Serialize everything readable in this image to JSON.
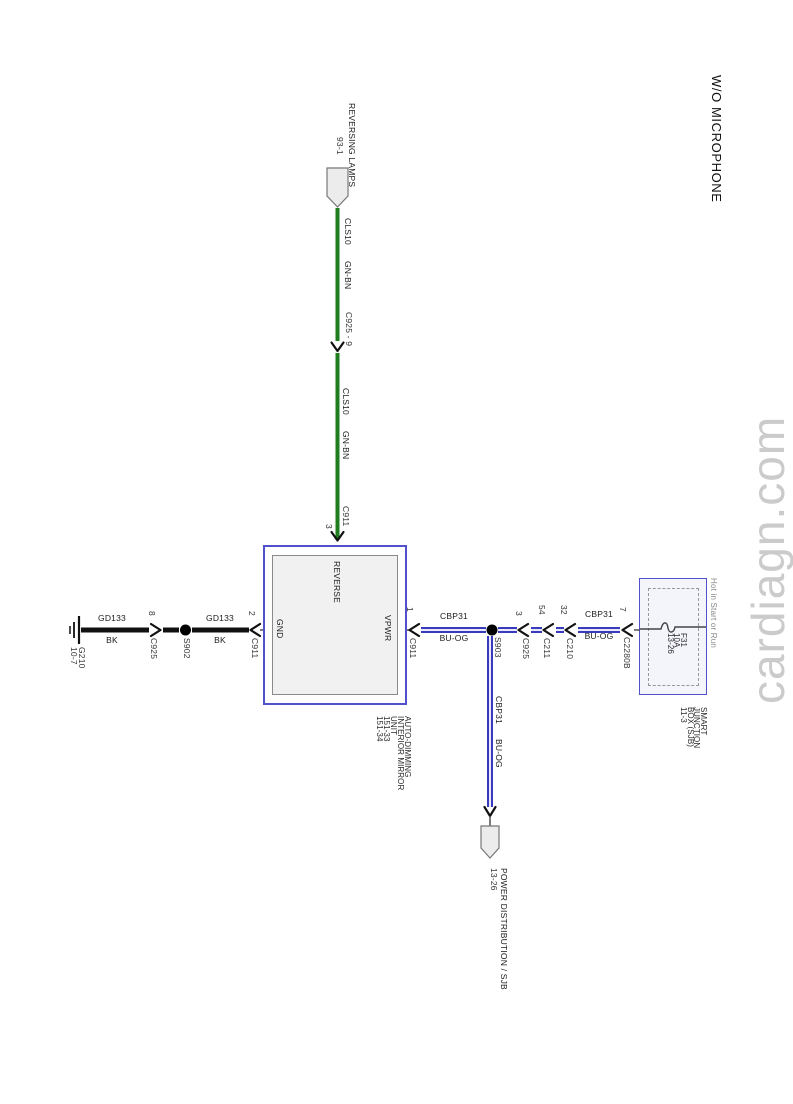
{
  "title": "W/O MICROPHONE",
  "watermark": "cardiagn.com",
  "colors": {
    "green_wire": "#1e7d1e",
    "blue_wire": "#3a3abc",
    "box_border": "#5151cd",
    "watermark_gray": "#cbcbcb",
    "muted_text": "#8a8a8a"
  },
  "offpage_top": {
    "name": "REVERSING LAMPS",
    "page_ref": "93-1"
  },
  "reverse_wire": {
    "seg1": {
      "circuit": "CLS10",
      "color": "GN-BN"
    },
    "connector1": {
      "name": "C925 - 9"
    },
    "seg2": {
      "circuit": "CLS10",
      "color": "GN-BN"
    },
    "connector2": {
      "name": "C911",
      "pin": "3"
    }
  },
  "mirror_unit": {
    "pins": {
      "reverse": "REVERSE",
      "gnd": "GND",
      "vpwr": "VPWR"
    },
    "label_lines": [
      "AUTO-DIMMING",
      "INTERIOR MIRROR",
      "UNIT",
      "151-33",
      "151-34"
    ]
  },
  "gnd_branch": {
    "c911": {
      "name": "C911",
      "pin": "2"
    },
    "wire1": {
      "circuit": "GD133",
      "color": "BK"
    },
    "splice": "S902",
    "c925": {
      "name": "C925",
      "pin": "8"
    },
    "wire2": {
      "circuit": "GD133",
      "color": "BK"
    },
    "ground": {
      "name": "G210",
      "page_ref": "10-7"
    }
  },
  "vpwr_branch": {
    "c911": {
      "name": "C911",
      "pin": "1"
    },
    "wire1": {
      "circuit": "CBP31",
      "color": "BU-OG"
    },
    "splice": "S903",
    "c925": {
      "name": "C925",
      "pin": "3"
    },
    "c211": {
      "name": "C211",
      "pin": "54"
    },
    "c210": {
      "name": "C210",
      "pin": "32"
    },
    "wire2": {
      "circuit": "CBP31",
      "color": "BU-OG"
    },
    "c2280b": {
      "name": "C2280B",
      "pin": "7"
    }
  },
  "sjb": {
    "hot_label": "Hot in Start or Run",
    "fuse_lines": [
      "F31",
      "10A",
      "13-26"
    ],
    "label_lines": [
      "SMART",
      "JUNCTION",
      "BOX (SJB)",
      "11-3"
    ]
  },
  "power_branch": {
    "wire": {
      "circuit": "CBP31",
      "color": "BU-OG"
    },
    "dest_line1": "POWER DISTRIBUTION / SJB",
    "dest_line2": "13-26"
  }
}
